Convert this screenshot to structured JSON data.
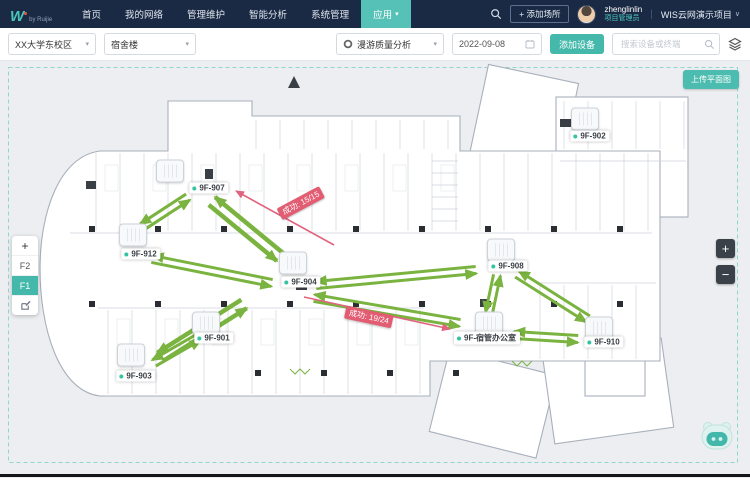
{
  "ui": {
    "caret": "▾"
  },
  "colors": {
    "topbar_bg": "#1b2a44",
    "accent": "#45b8ac",
    "active_menu": "#56c1b6",
    "arrow_green": "#7ab33f",
    "arrow_pink": "#e0647f",
    "badge_bg": "#e25c72"
  },
  "topbar": {
    "logo": {
      "mark": "W",
      "byline": "by Ruijie"
    },
    "menu": [
      {
        "label": "首页",
        "active": false
      },
      {
        "label": "我的网络",
        "active": false
      },
      {
        "label": "管理维护",
        "active": false
      },
      {
        "label": "智能分析",
        "active": false
      },
      {
        "label": "系统管理",
        "active": false
      },
      {
        "label": "应用",
        "active": true,
        "caret": true
      }
    ],
    "add_place_label": "+ 添加场所",
    "user": {
      "name": "zhenglinlin",
      "role": "项目管理员"
    },
    "divider": "|",
    "project_label": "WIS云网演示项目",
    "project_caret": "∨"
  },
  "toolbar": {
    "site_select": "XX大学东校区",
    "building_select": "宿舍楼",
    "analysis_select": "漫游质量分析",
    "date_value": "2022-09-08",
    "add_device_label": "添加设备",
    "search_placeholder": "搜索设备或终端"
  },
  "canvas": {
    "upload_button_label": "上传平面图",
    "controls": {
      "add": "+",
      "floors": [
        {
          "label": "F2",
          "active": false
        },
        {
          "label": "F1",
          "active": true
        }
      ],
      "zoom_in": "+",
      "zoom_out": "−"
    },
    "aps": [
      {
        "name": "9F-907",
        "icon": [
          170,
          110
        ],
        "label": [
          209,
          127
        ]
      },
      {
        "name": "9F-912",
        "icon": [
          133,
          174
        ],
        "label": [
          141,
          193
        ]
      },
      {
        "name": "9F-904",
        "icon": [
          293,
          202
        ],
        "label": [
          301,
          221
        ]
      },
      {
        "name": "9F-901",
        "icon": [
          206,
          262
        ],
        "label": [
          214,
          277
        ]
      },
      {
        "name": "9F-903",
        "icon": [
          131,
          294
        ],
        "label": [
          136,
          315
        ]
      },
      {
        "name": "9F-908",
        "icon": [
          501,
          189
        ],
        "label": [
          508,
          205
        ]
      },
      {
        "name": "9F-宿管办公室",
        "icon": [
          489,
          262
        ],
        "label": [
          487,
          277
        ]
      },
      {
        "name": "9F-910",
        "icon": [
          599,
          267
        ],
        "label": [
          604,
          281
        ]
      },
      {
        "name": "9F-902",
        "icon": [
          585,
          58
        ],
        "label": [
          590,
          75
        ]
      }
    ],
    "arrows": {
      "green_pairs": [
        {
          "p": [
            188,
            136,
            142,
            166
          ],
          "w": 3
        },
        {
          "p": [
            212,
            140,
            280,
            196
          ],
          "w": 4.5
        },
        {
          "p": [
            152,
            198,
            272,
            222
          ],
          "w": 3
        },
        {
          "p": [
            160,
            296,
            244,
            243
          ],
          "w": 4.5
        },
        {
          "p": [
            199,
            276,
            154,
            302
          ],
          "w": 3
        },
        {
          "p": [
            314,
            237,
            460,
            262
          ],
          "w": 3
        },
        {
          "p": [
            316,
            224,
            476,
            209
          ],
          "w": 3
        },
        {
          "p": [
            497,
            214,
            489,
            252
          ],
          "w": 3
        },
        {
          "p": [
            517,
            213,
            588,
            258
          ],
          "w": 3
        },
        {
          "p": [
            514,
            274,
            578,
            278
          ],
          "w": 3
        }
      ],
      "pink": [
        {
          "p": [
            334,
            184,
            236,
            130
          ]
        },
        {
          "p": [
            304,
            236,
            450,
            268
          ]
        }
      ]
    },
    "badges": [
      {
        "text": "成功: 15/15",
        "x": 301,
        "y": 142,
        "rot": -28
      },
      {
        "text": "成功: 19/24",
        "x": 369,
        "y": 256,
        "rot": 12
      }
    ]
  }
}
